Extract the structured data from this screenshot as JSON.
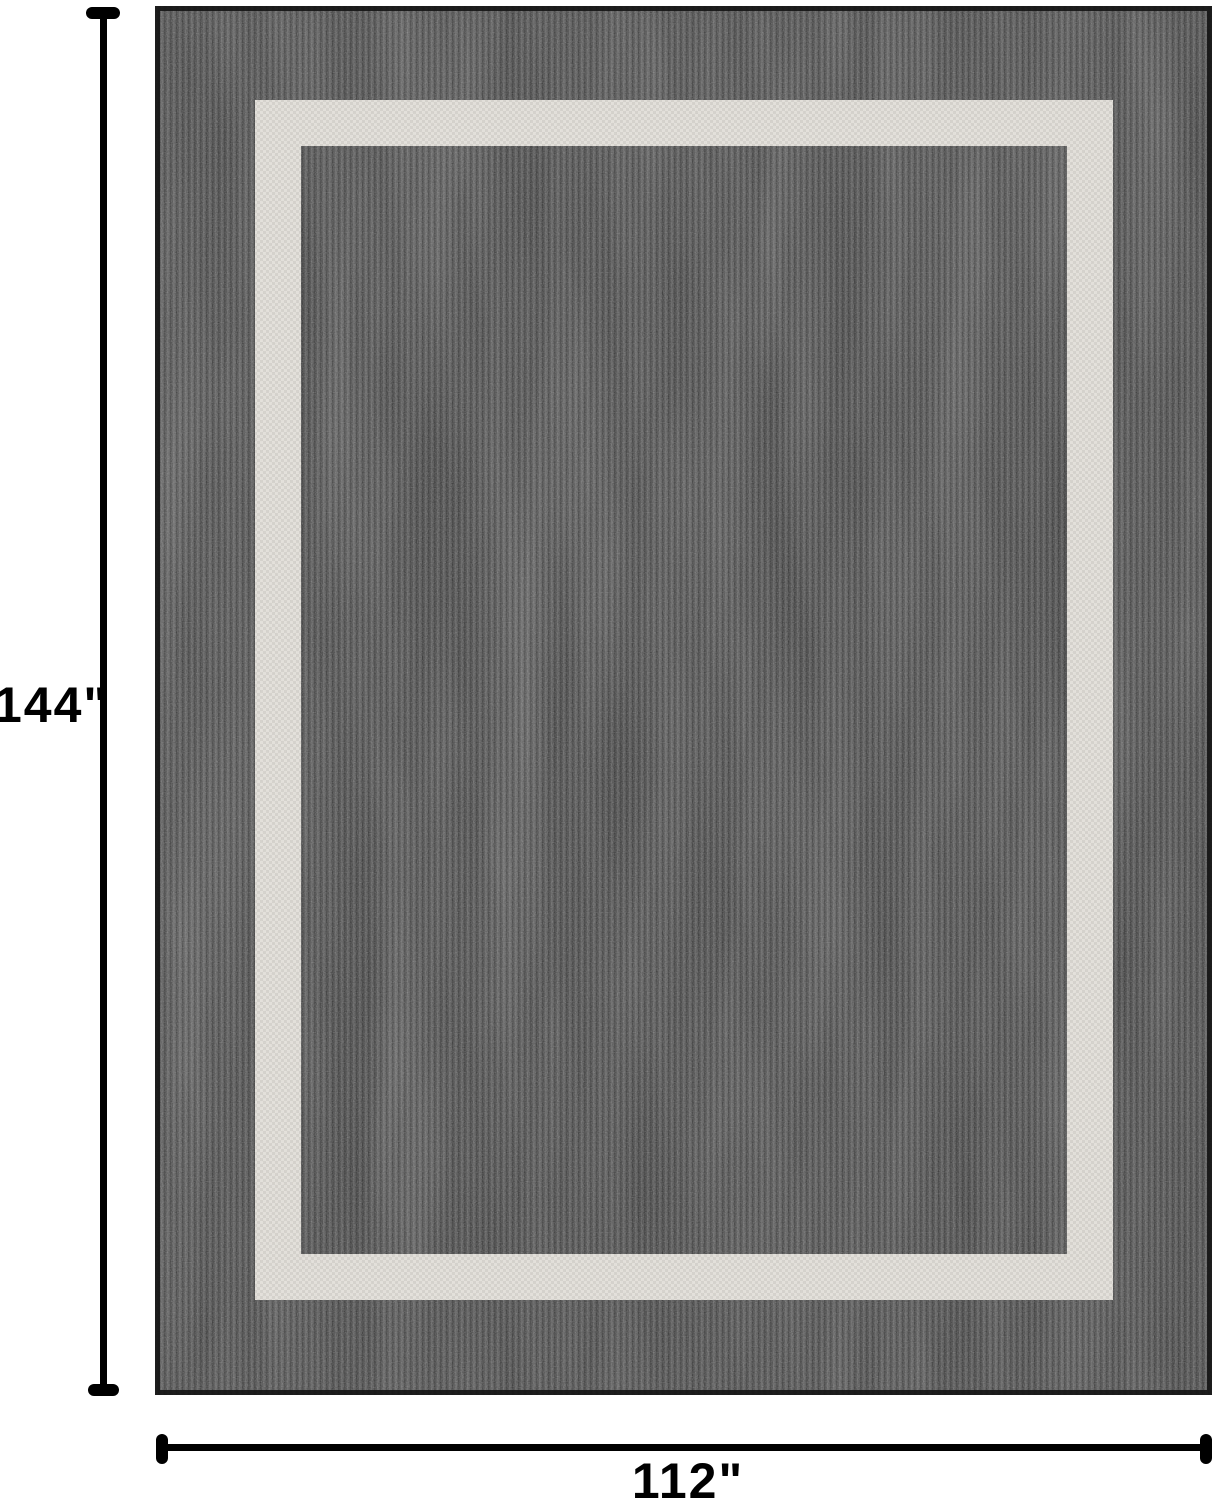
{
  "figure": {
    "kind": "rug-dimension-diagram"
  },
  "dimensions": {
    "height_label": "144\"",
    "width_label": "112\""
  },
  "colors": {
    "background": "#ffffff",
    "rug_field": "#3b3b3b",
    "rug_edge": "#141414",
    "border_band": "#e6e3dd",
    "band_check": "#c7c4be",
    "line": "#000000"
  }
}
